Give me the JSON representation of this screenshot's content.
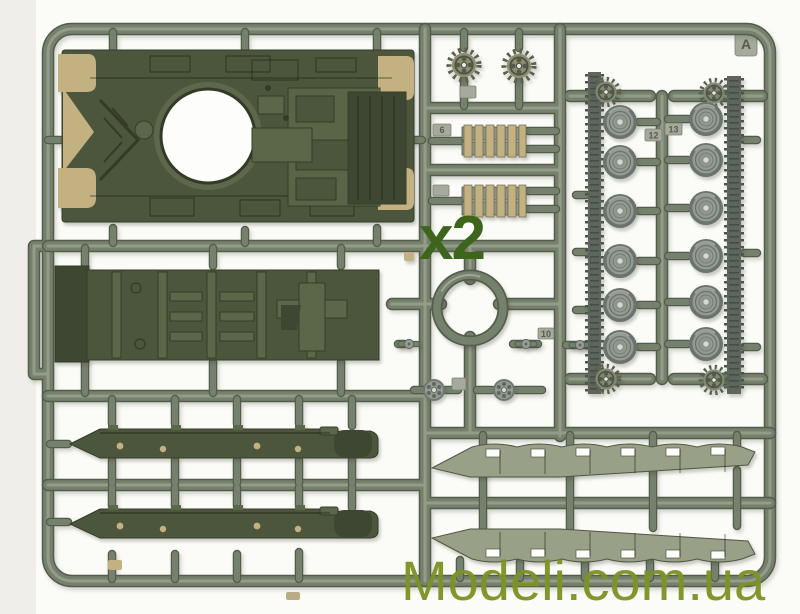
{
  "meta": {
    "description": "Photo of injection-molded model kit sprue A: olive green tank parts (hull, wheels, tracks, fenders) on a runner frame"
  },
  "markings": {
    "quantity": "x2",
    "sprue_letter": "A",
    "part_numbers": {
      "track_section": "6",
      "idler_group": "10",
      "left_wheel_column": "12",
      "right_wheel_column": "13"
    }
  },
  "watermark": {
    "text": "Modeli.com.ua",
    "color": "#7d9324"
  },
  "colors": {
    "background": "#fbfbf8",
    "runner": "#75806d",
    "runner_dark": "#525d4b",
    "runner_highlight": "#9ca691",
    "part_olive": "#4c563c",
    "part_olive_dark": "#3e4731",
    "part_olive_light": "#5c674a",
    "part_tan": "#c3b182",
    "wheel_grey": "#939b93",
    "wheel_rim": "#6b746c",
    "sprocket": "#848b76",
    "track": "#5c665c",
    "fender": "#98a087",
    "tab": "#a6aa9c",
    "tab_text": "#565d4e",
    "marking_green": "#3e651c",
    "watermark_green": "#7d9324"
  },
  "parts": [
    {
      "name": "upper-hull",
      "count": 1
    },
    {
      "name": "lower-hull",
      "count": 1
    },
    {
      "name": "hull-side-panel",
      "count": 2
    },
    {
      "name": "drive-sprocket",
      "count": 6
    },
    {
      "name": "track-link-section",
      "count": 2
    },
    {
      "name": "turret-ring",
      "count": 1
    },
    {
      "name": "idler-wheel",
      "count": 2
    },
    {
      "name": "road-wheel",
      "count": 12
    },
    {
      "name": "track-run",
      "count": 2
    },
    {
      "name": "fender",
      "count": 2
    }
  ]
}
